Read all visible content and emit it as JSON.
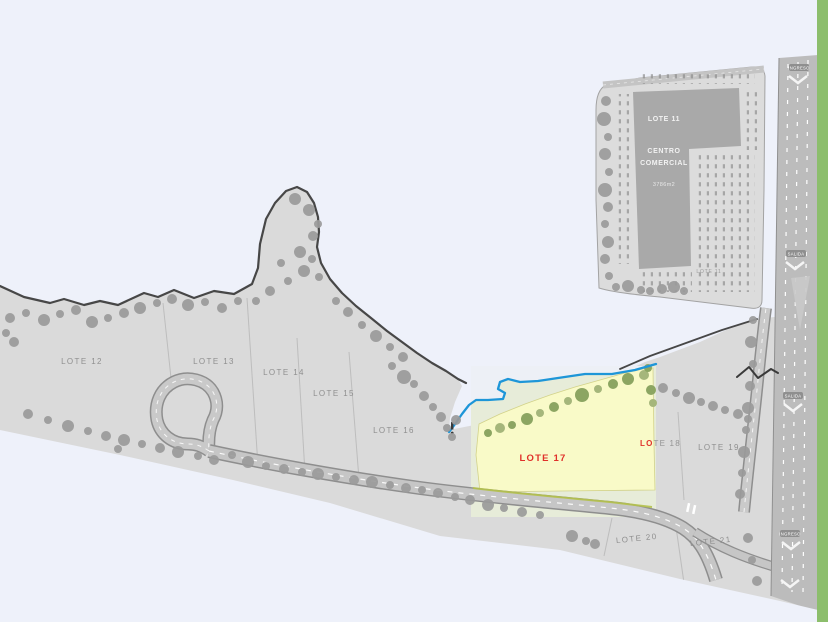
{
  "map": {
    "region_labels": [
      {
        "text": "LOTE 12"
      },
      {
        "text": "LOTE 13"
      },
      {
        "text": "LOTE 14"
      },
      {
        "text": "LOTE 15"
      },
      {
        "text": "LOTE 16"
      },
      {
        "text": "LOTE 19"
      },
      {
        "text": "LOTE 20"
      },
      {
        "text": "LOTE 21"
      }
    ],
    "highlight": {
      "label": "LOTE 17"
    },
    "lote18": {
      "inside": "LO",
      "outside": "TE 18"
    },
    "commercial": {
      "lines": [
        "LOTE 11",
        "CENTRO",
        "COMERCIAL",
        "3786m2"
      ],
      "corner_label": "LOTE 11"
    },
    "highway": {
      "stations": [
        {
          "text": "INGRESO"
        },
        {
          "text": "SALIDA"
        },
        {
          "text": "SALIDA"
        },
        {
          "text": "INGRESO"
        }
      ]
    },
    "colors": {
      "background": "#eef1fa",
      "land": "#dadada",
      "land_outline": "#474747",
      "road": "#c6c6c6",
      "road_edge": "#8e8e8e",
      "highway": "#bcbcbc",
      "tree_gray": "#9b9b9b",
      "parcel": "#dcdcdc",
      "building": "#a9a9a9",
      "highlight_fill": "#f9fac8",
      "highlight_bg": "#e7ecd9",
      "tree_olive": "#8ca562",
      "stream_blue": "#1e96d8",
      "label_red": "#e0302a",
      "label_gray": "#8f8f8f",
      "sidebar_green": "#8cbe6c",
      "lane_yellow": "#b5c24c"
    }
  }
}
